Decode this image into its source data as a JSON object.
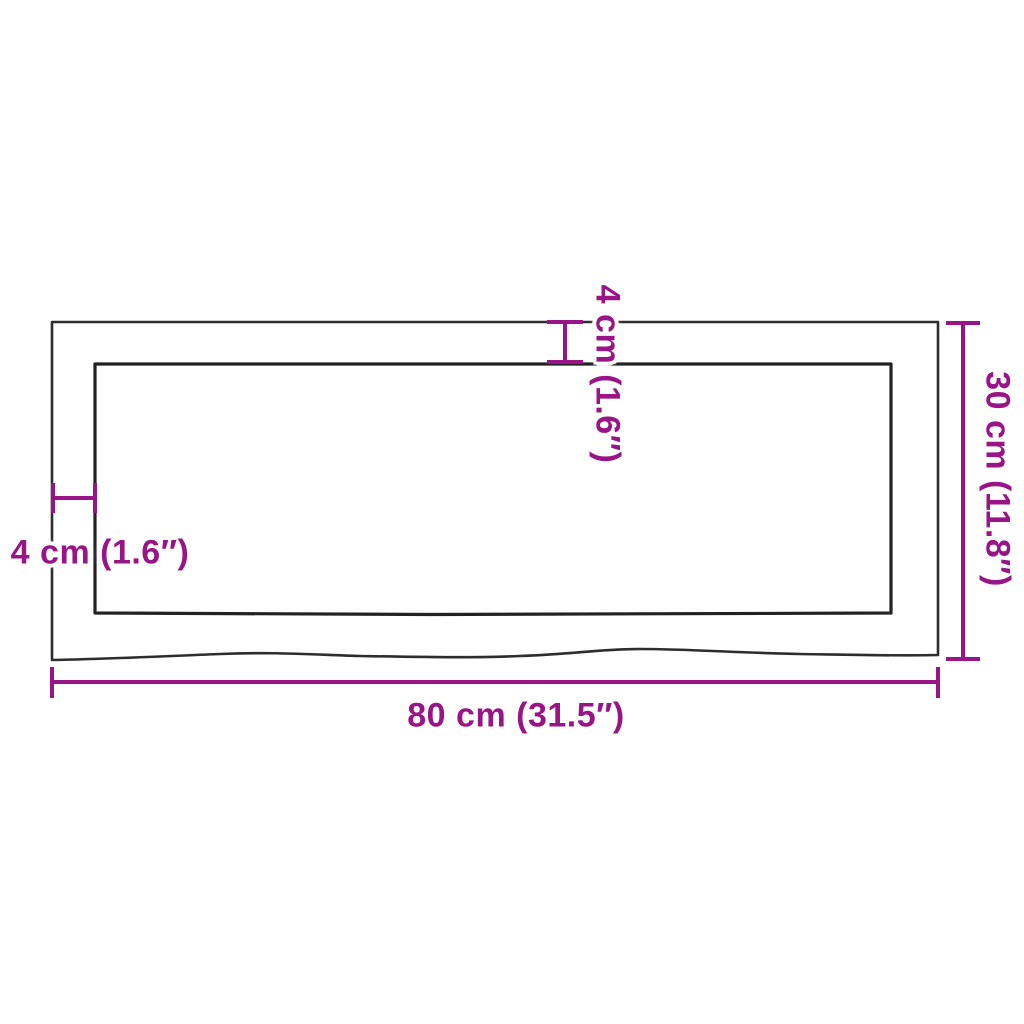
{
  "diagram": {
    "type": "product-dimension-diagram",
    "subject": "wall shelf / tabletop top view with live edge",
    "labels": {
      "width": "80 cm (31.5″)",
      "height": "30 cm (11.8″)",
      "thickness_top": "4 cm (1.6″)",
      "thickness_left": "4 cm (1.6″)"
    },
    "colors": {
      "dimension_accent": "#981487",
      "outline_outer": "#2d2d2d",
      "outline_inner": "#222222",
      "background": "#ffffff"
    }
  }
}
